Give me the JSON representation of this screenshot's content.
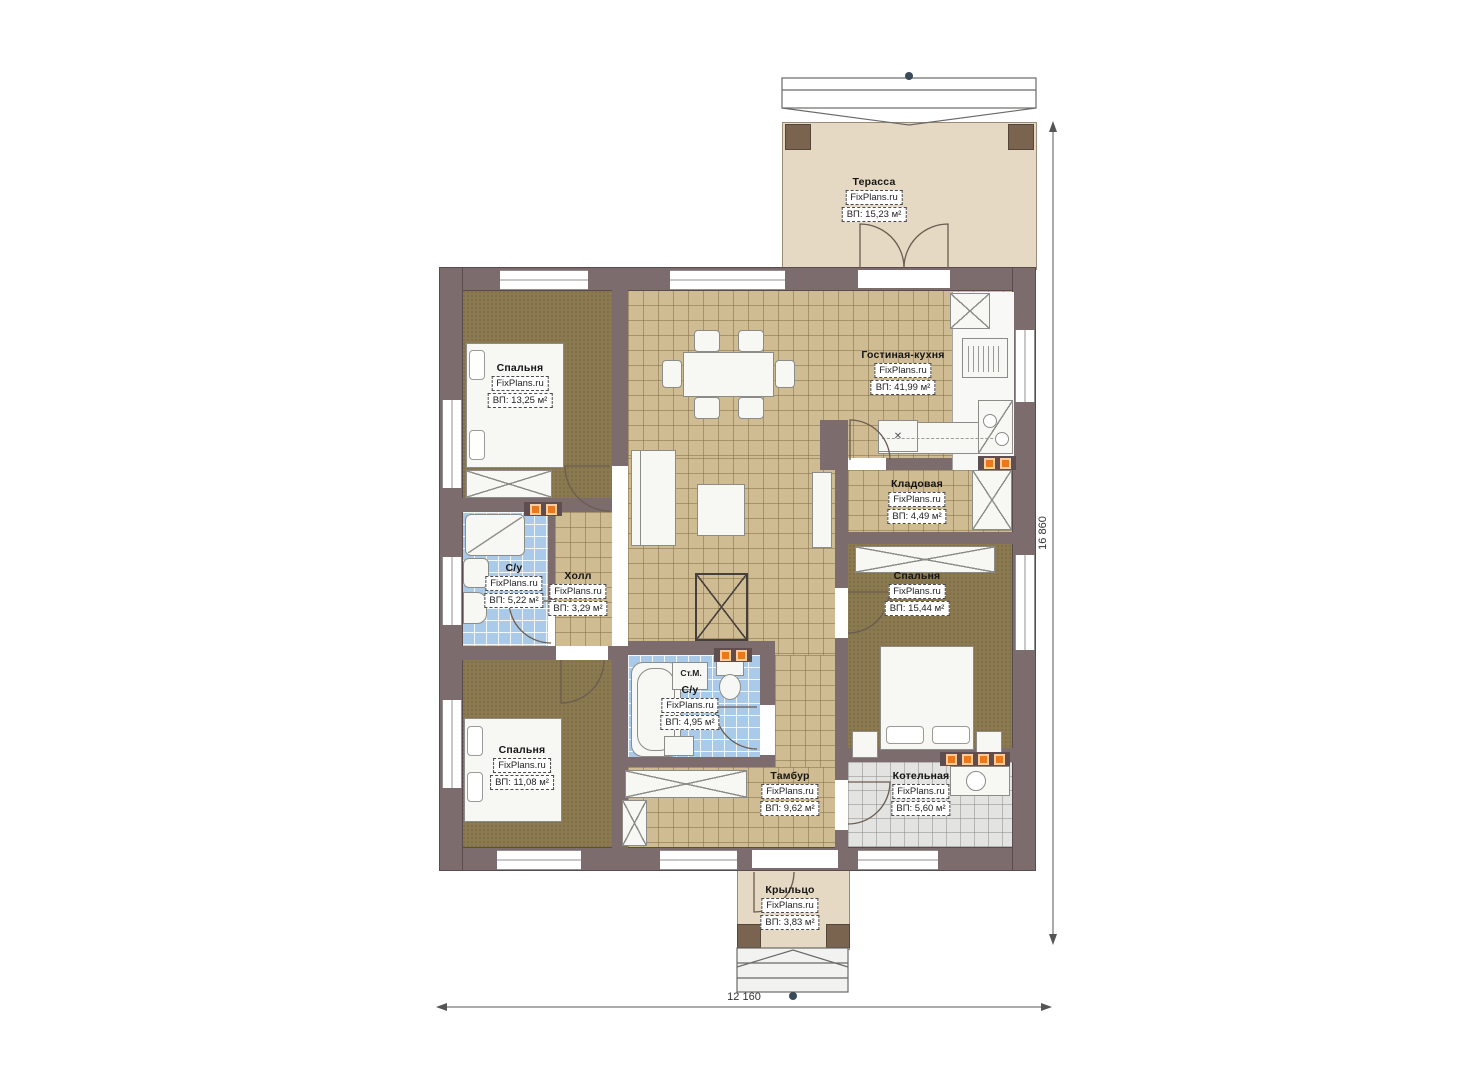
{
  "plan": {
    "brand": "FixPlans.ru",
    "rooms": [
      {
        "id": "terrace",
        "name": "Терасса",
        "area": "ВП: 15,23 м²"
      },
      {
        "id": "bedroom-top-left",
        "name": "Спальня",
        "area": "ВП: 13,25 м²"
      },
      {
        "id": "living-kitchen",
        "name": "Гостиная-кухня",
        "area": "ВП: 41,99 м²"
      },
      {
        "id": "storage",
        "name": "Кладовая",
        "area": "ВП: 4,49 м²"
      },
      {
        "id": "bathroom-left",
        "name": "С/у",
        "area": "ВП: 5,22 м²"
      },
      {
        "id": "hall",
        "name": "Холл",
        "area": "ВП: 3,29 м²"
      },
      {
        "id": "bedroom-right",
        "name": "Спальня",
        "area": "ВП: 15,44 м²"
      },
      {
        "id": "bathroom-middle",
        "name": "С/у",
        "area": "ВП: 4,95 м²"
      },
      {
        "id": "bedroom-bottom-left",
        "name": "Спальня",
        "area": "ВП: 11,08 м²"
      },
      {
        "id": "tambour",
        "name": "Тамбур",
        "area": "ВП: 9,62 м²"
      },
      {
        "id": "boiler-room",
        "name": "Котельная",
        "area": "ВП: 5,60 м²"
      },
      {
        "id": "porch",
        "name": "Крыльцо",
        "area": "ВП: 3,83 м²"
      }
    ],
    "annotations": {
      "washing_machine": "Ст.М."
    },
    "dimensions": {
      "right": "16 860",
      "bottom": "12 160"
    },
    "icons": {
      "island_mark": "✕"
    },
    "colors": {
      "wall": "#7d6c6e",
      "carpet": "#8b7950",
      "tile_tan": "#cfbc92",
      "tile_blue": "#a9cbe9",
      "tile_gray": "#e3e3e1",
      "deck": "#e6d9c3",
      "vent_orange": "#e9791e"
    }
  }
}
